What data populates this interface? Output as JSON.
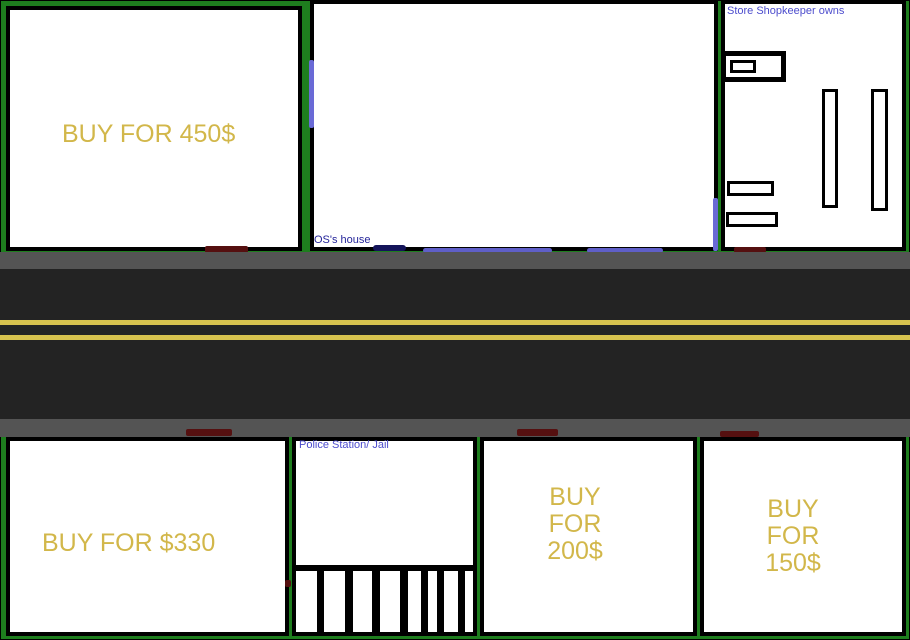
{
  "plots": {
    "plot_450": {
      "price_label": "BUY FOR 450$"
    },
    "os_house": {
      "label": "OS's house"
    },
    "store": {
      "label": "Store Shopkeeper owns"
    },
    "plot_330": {
      "price_label": "BUY FOR $330"
    },
    "police": {
      "label": "Police Station/ Jail"
    },
    "plot_200": {
      "price_line1": "BUY FOR",
      "price_line2": "200$"
    },
    "plot_150": {
      "price_line1": "BUY FOR",
      "price_line2": "150$"
    }
  },
  "colors": {
    "grass": "#1e7e1e",
    "building_fill": "#ffffff",
    "outline": "#000000",
    "price_text": "#d2b74a",
    "label_text": "#4c4ccd",
    "os_label_text": "#26269b",
    "sidewalk": "#545454",
    "asphalt": "#232323",
    "road_line": "#d7c24e",
    "door": "#551010",
    "mat_navy": "#14145a",
    "mat_blue": "#5f5fc8",
    "window_blue": "#6a6ad6"
  }
}
